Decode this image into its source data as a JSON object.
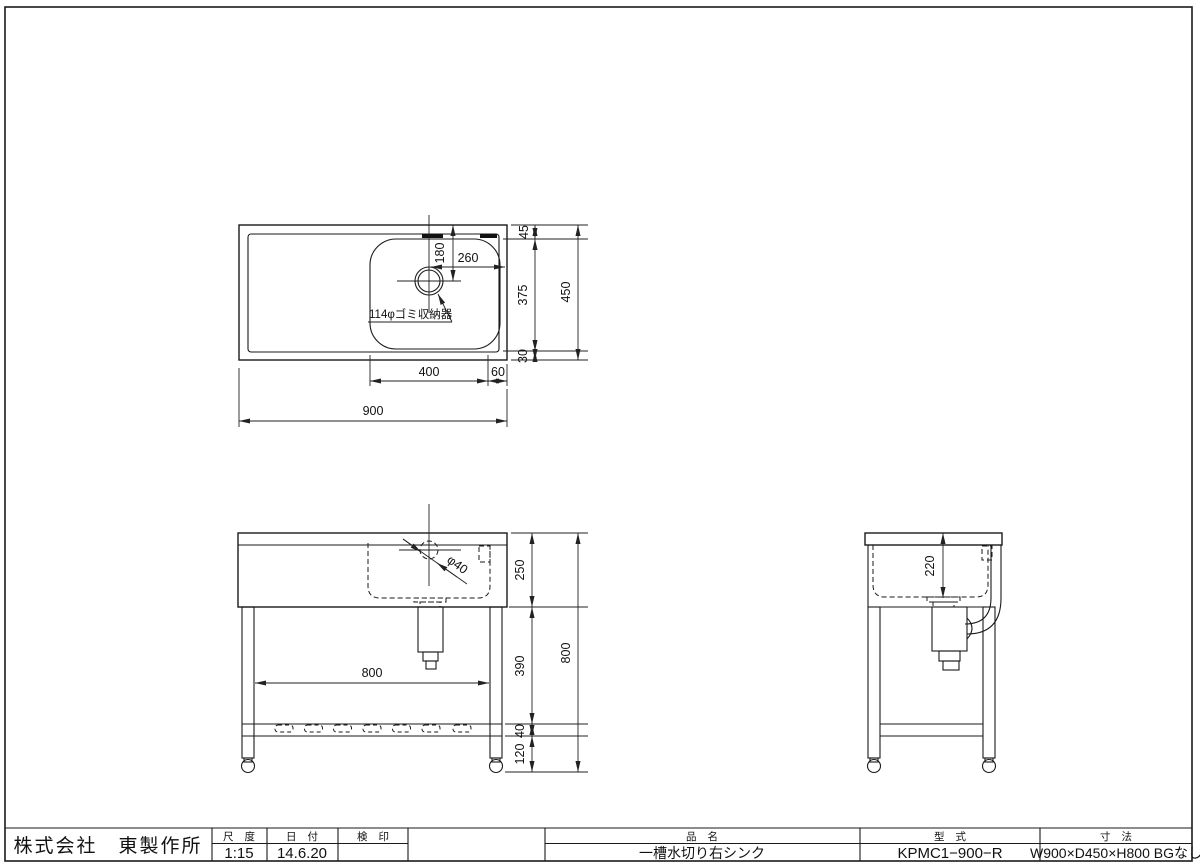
{
  "sheet": {
    "background": "#ffffff",
    "line_color": "#1a1a1a"
  },
  "title_block": {
    "company": "株式会社　東製作所",
    "scale_label": "尺 度",
    "scale_value": "1:15",
    "date_label": "日 付",
    "date_value": "14.6.20",
    "stamp_label": "検 印",
    "stamp_value": "",
    "name_label": "品 名",
    "name_value": "一槽水切り右シンク",
    "model_label": "型 式",
    "model_value": "KPMC1−900−R",
    "size_label": "寸 法",
    "size_value": "W900×D450×H800 BGなし"
  },
  "plan_view": {
    "d45": "45",
    "d180": "180",
    "d260": "260",
    "d375": "375",
    "d450": "450",
    "d30": "30",
    "d400": "400",
    "d60": "60",
    "d900": "900",
    "drain_label": "114φゴミ収納器"
  },
  "front_view": {
    "d250": "250",
    "d390": "390",
    "d40": "40",
    "d120": "120",
    "d800_height": "800",
    "d800_width": "800",
    "drain_dia": "φ40"
  },
  "side_view": {
    "d220": "220"
  }
}
